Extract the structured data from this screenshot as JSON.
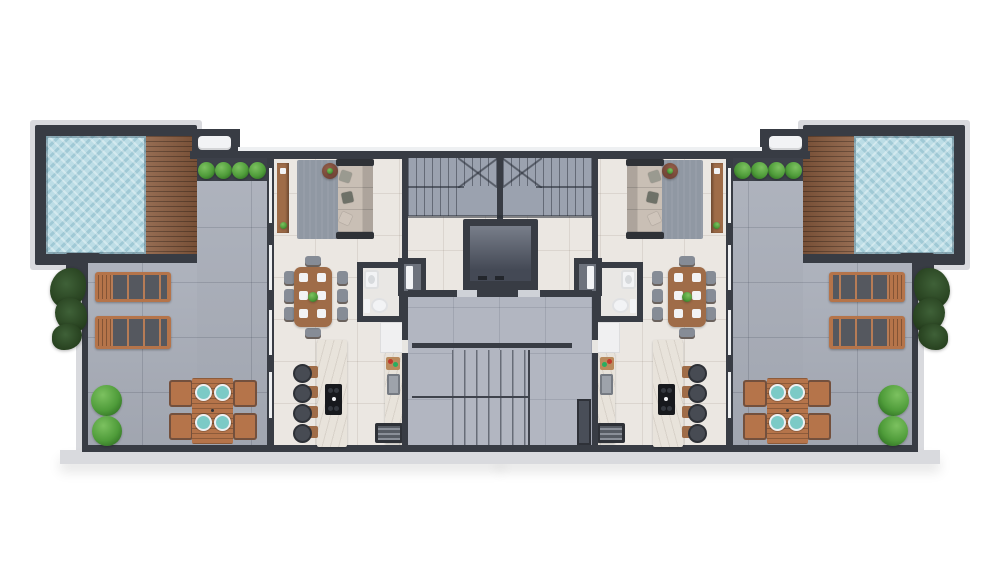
{
  "title": "Penthouse roof level floor plan - 3D top-down architectural render, two mirrored apartments",
  "palette": {
    "wall": "#383c44",
    "apron": "#d9dade",
    "glass": "#eef0f2",
    "white_fixture": "#f2f3f5",
    "terrace": "#a9aeb9",
    "interior": "#ebe7e2",
    "hall": "#b2b6c1",
    "stair": "#9ba2af",
    "pool": "#bcdde6",
    "deck": "#8a5c3f",
    "wood": "#9f6c48",
    "wood_bright": "#b5744a",
    "marble": "#e8e3db",
    "rug": "#9098a3",
    "sofa": "#c9bfb5",
    "fabric_dark": "#55585f",
    "bush": "#4f9c3a",
    "bush_dark": "#2e6e22",
    "teal": "#7ccac6",
    "steel": "#9ea3ab",
    "elevator": "#5d6370"
  },
  "plan": {
    "apartments": 2,
    "layout": "mirrored left-right",
    "areas": [
      "swimming pool",
      "wood pool deck",
      "roof terrace",
      "living room",
      "dining area",
      "kitchen",
      "bathroom",
      "entry",
      "duplex stair",
      "elevator",
      "common stair hall"
    ],
    "furniture": [
      "pool bench",
      "planter bushes",
      "sun loungers",
      "outdoor dining table with four chairs and teal plates",
      "sofa with pillows",
      "area rug",
      "round side table",
      "console sideboard",
      "eight-seat dining table",
      "kitchen island with cooktop",
      "four bar stools",
      "kitchen counter with sink and cutting board",
      "grill",
      "washbasin",
      "toilet",
      "white cabinet",
      "hanging dark plants"
    ]
  }
}
